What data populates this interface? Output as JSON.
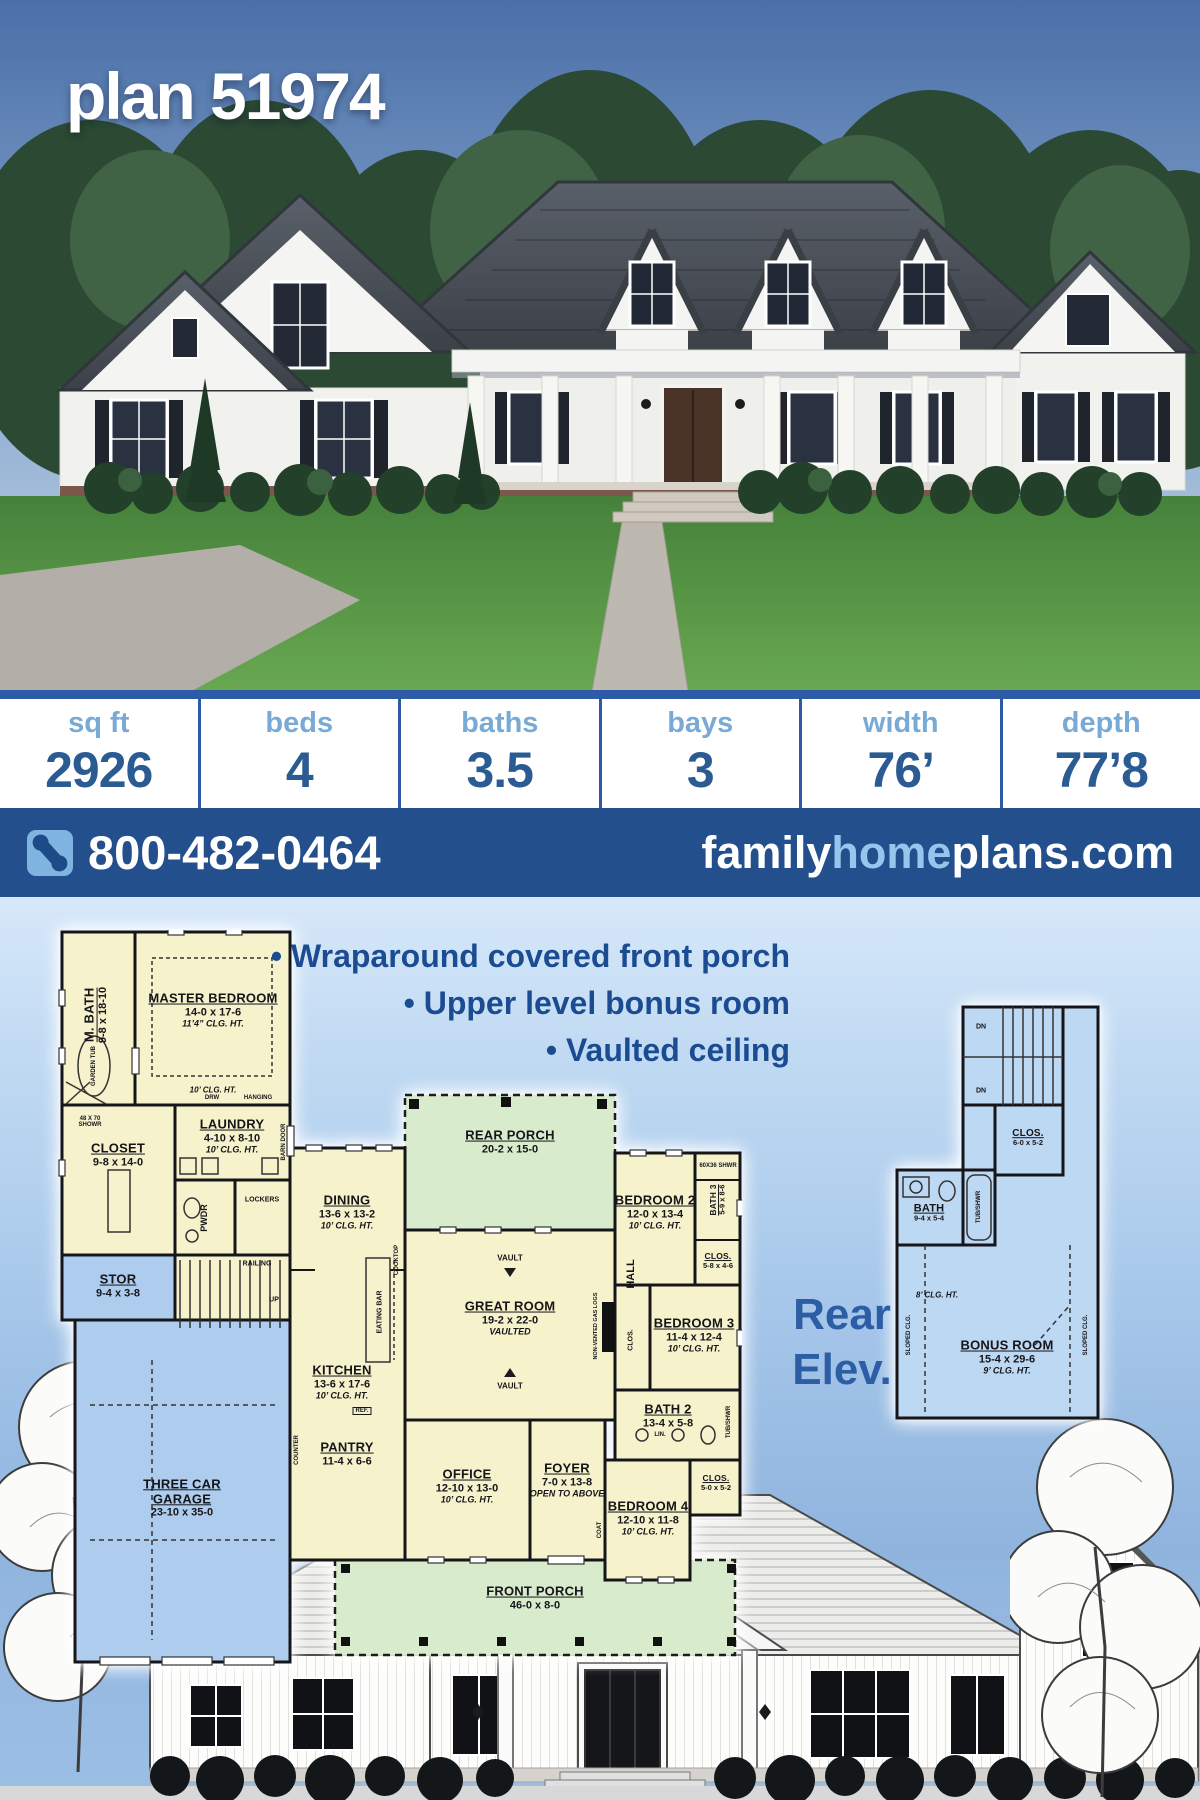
{
  "title": "plan 51974",
  "stats": {
    "columns": [
      {
        "label": "sq ft",
        "value": "2926"
      },
      {
        "label": "beds",
        "value": "4"
      },
      {
        "label": "baths",
        "value": "3.5"
      },
      {
        "label": "bays",
        "value": "3"
      },
      {
        "label": "width",
        "value": "76’"
      },
      {
        "label": "depth",
        "value": "77’8"
      }
    ]
  },
  "contact": {
    "phone": "800-482-0464",
    "phone_icon": "phone-icon",
    "site": {
      "family": "family",
      "home": "home",
      "plans": "plans.com"
    }
  },
  "features": [
    "• Wraparound covered front porch",
    "• Upper level bonus room",
    "• Vaulted ceiling"
  ],
  "rear_elevation": {
    "line1": "Rear",
    "line2": "Elev."
  },
  "main_floor": {
    "rooms": [
      {
        "name": "M. BATH",
        "dims": "9-8 x 18-10"
      },
      {
        "name": "MASTER BEDROOM",
        "dims": "14-0 x 17-6",
        "note": "11’4” CLG. HT."
      },
      {
        "name": "CLOSET",
        "dims": "9-8 x 14-0"
      },
      {
        "name": "LAUNDRY",
        "dims": "4-10 x 8-10",
        "note": "10’ CLG. HT."
      },
      {
        "name": "STOR",
        "dims": "9-4 x 3-8"
      },
      {
        "name": "THREE CAR GARAGE",
        "dims": "23-10 x 35-0"
      },
      {
        "name": "DINING",
        "dims": "13-6 x 13-2",
        "note": "10’ CLG. HT."
      },
      {
        "name": "REAR PORCH",
        "dims": "20-2 x 15-0"
      },
      {
        "name": "GREAT ROOM",
        "dims": "19-2 x 22-0",
        "note": "VAULTED"
      },
      {
        "name": "KITCHEN",
        "dims": "13-6 x 17-6",
        "note": "10’ CLG. HT."
      },
      {
        "name": "PANTRY",
        "dims": "11-4 x 6-6"
      },
      {
        "name": "OFFICE",
        "dims": "12-10 x 13-0",
        "note": "10’ CLG. HT."
      },
      {
        "name": "FOYER",
        "dims": "7-0 x 13-8",
        "note": "OPEN TO ABOVE"
      },
      {
        "name": "BEDROOM 2",
        "dims": "12-0 x 13-4",
        "note": "10’ CLG. HT."
      },
      {
        "name": "BATH 3",
        "dims": "5-9 x 8-6"
      },
      {
        "name": "CLOS.",
        "dims": "5-8 x 4-6"
      },
      {
        "name": "BEDROOM 3",
        "dims": "11-4 x 12-4",
        "note": "10’ CLG. HT."
      },
      {
        "name": "BATH 2",
        "dims": "13-4 x 5-8"
      },
      {
        "name": "BEDROOM 4",
        "dims": "12-10 x 11-8",
        "note": "10’ CLG. HT."
      },
      {
        "name": "CLOS.",
        "dims": "5-0 x 5-2"
      },
      {
        "name": "FRONT PORCH",
        "dims": "46-0 x 8-0"
      }
    ],
    "annotations": [
      "10’ CLG. HT.",
      "PWDR",
      "LOCKERS",
      "RAILING",
      "UP",
      "GARDEN TUB",
      "48 X 70 SHOWR",
      "HANGING",
      "DRW",
      "BARN DOOR",
      "EATING BAR",
      "VAULT",
      "VAULT",
      "NON-VENTED GAS LOGS",
      "HALL",
      "CLOS.",
      "COAT",
      "TUB/SHWR",
      "60X36 SHWR",
      "REF.",
      "COOKTOP",
      "COUNTER",
      "LIN."
    ]
  },
  "upper_floor": {
    "rooms": [
      {
        "name": "BONUS ROOM",
        "dims": "15-4 x 29-6",
        "note": "9’ CLG. HT."
      },
      {
        "name": "BATH",
        "dims": "9-4 x 5-4"
      },
      {
        "name": "CLOS.",
        "dims": "6-0 x 5-2"
      }
    ],
    "annotations": [
      "DN",
      "DN",
      "TUB/SHWR",
      "8’ CLG. HT.",
      "SLOPED CLG.",
      "SLOPED CLG."
    ]
  },
  "palette": {
    "bar_blue": "#234f8d",
    "light_blue": "#96c6ed",
    "stats_label": "#79aad5",
    "stats_value": "#2b5b93",
    "feature_text": "#1b4c92",
    "plan_yellow": "#f6f2cc",
    "plan_blue": "#aecdee",
    "plan_green": "#d8eccd",
    "bonus_blue": "#bdd8f2"
  }
}
